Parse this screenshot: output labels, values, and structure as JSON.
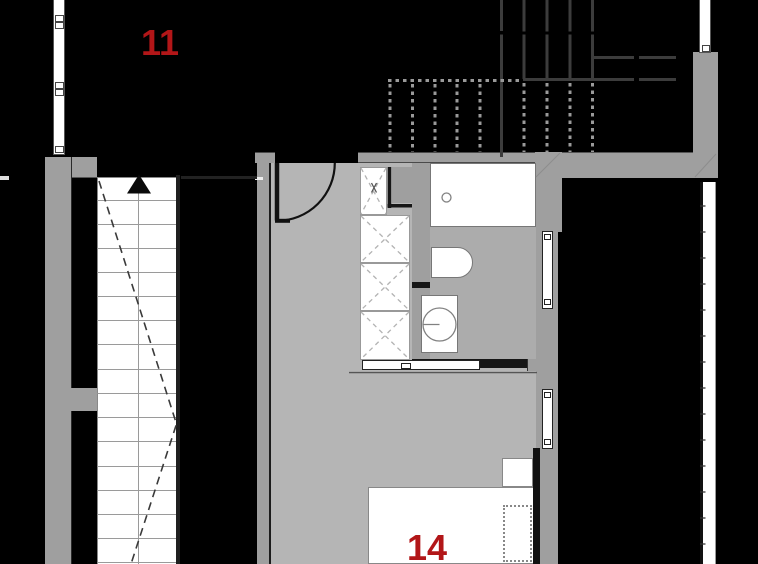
{
  "plan_title": "apartment-floor-plan",
  "labels": {
    "room_upper": "11",
    "room_lower": "14"
  },
  "colors": {
    "background": "#000000",
    "wall": "#9f9f9f",
    "floor": "#b5b5b5",
    "bath_floor": "#acacac",
    "beam": "#3c3c3c",
    "canopy_dash": "#9a9a9a",
    "label_red": "#b21618",
    "white": "#ffffff",
    "line_dark": "#161616"
  }
}
